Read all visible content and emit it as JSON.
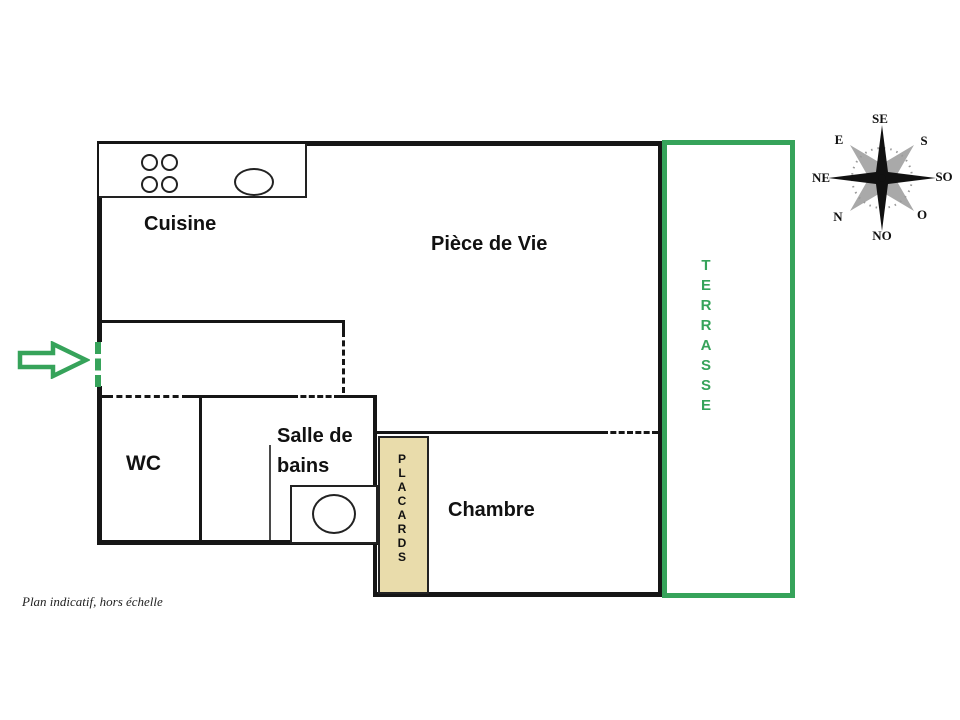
{
  "footnote": "Plan indicatif, hors échelle",
  "rooms": {
    "cuisine": "Cuisine",
    "piece_de_vie": "Pièce de Vie",
    "wc": "WC",
    "salle_de_bains_line1": "Salle de",
    "salle_de_bains_line2": "bains",
    "chambre": "Chambre",
    "placards_letters": [
      "P",
      "L",
      "A",
      "C",
      "A",
      "R",
      "D",
      "S"
    ],
    "terrasse_letters": [
      "T",
      "E",
      "R",
      "R",
      "A",
      "S",
      "S",
      "E"
    ]
  },
  "compass": {
    "up": "SE",
    "upper_right": "S",
    "right": "SO",
    "lower_right": "O",
    "down": "NO",
    "lower_left": "N",
    "left": "NE",
    "upper_left": "E"
  },
  "colors": {
    "wall_black": "#161616",
    "accent_green": "#36a35a",
    "placards_fill": "#e9dcab"
  }
}
